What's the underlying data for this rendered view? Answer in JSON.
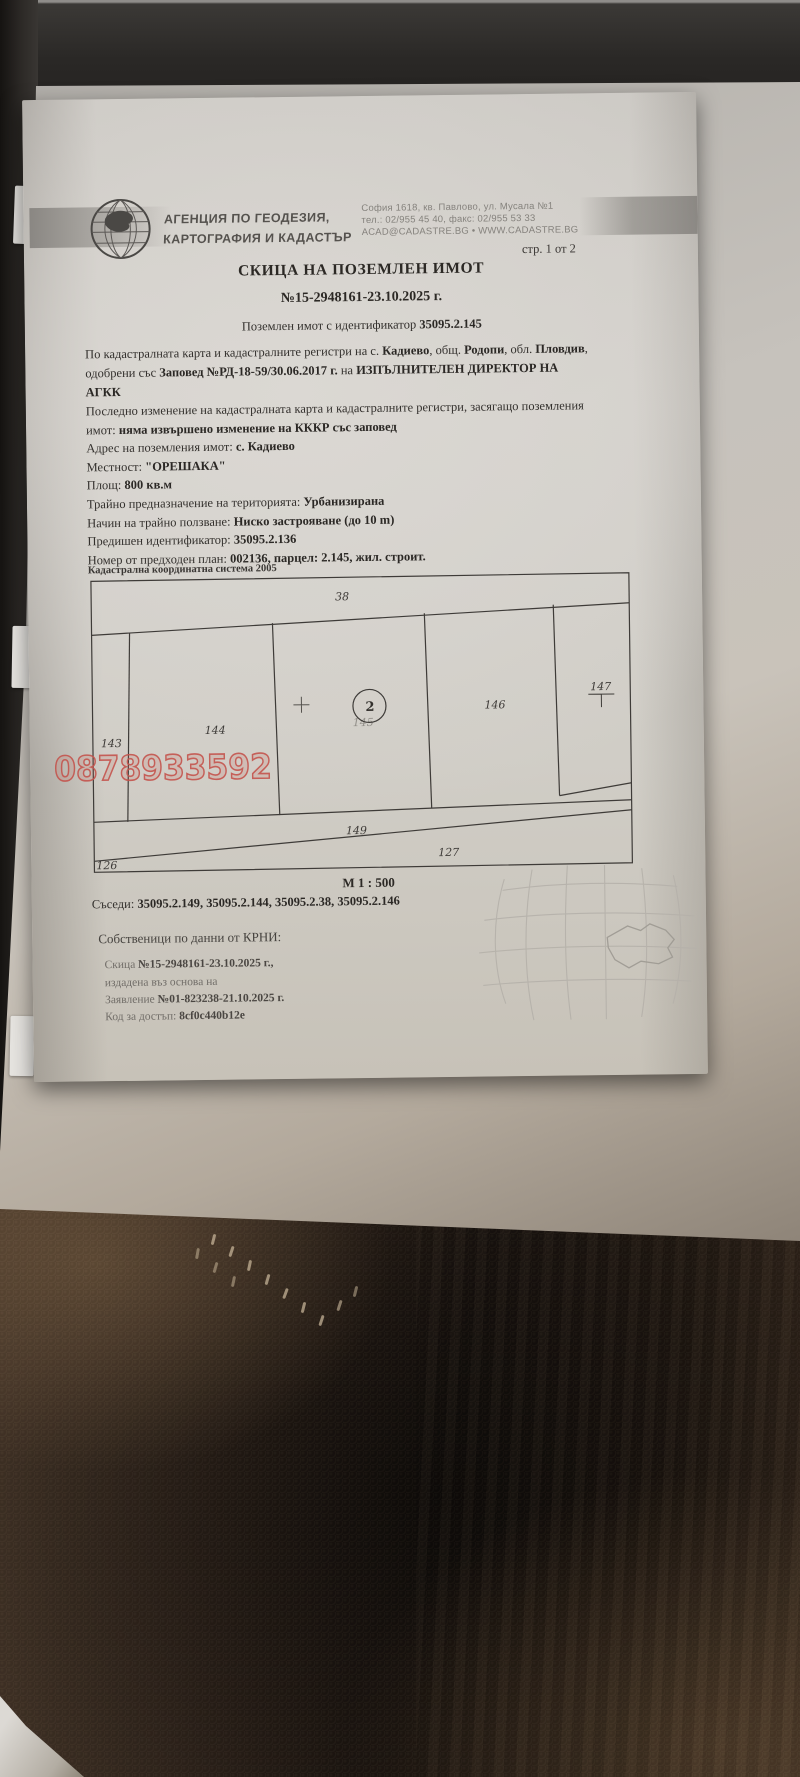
{
  "colors": {
    "watermark_red": "#c4544d",
    "paper": "#d0cdc8",
    "carpet_brown": "#2a211a",
    "ink": "#33302d"
  },
  "header": {
    "agency_line1": "АГЕНЦИЯ ПО ГЕОДЕЗИЯ,",
    "agency_line2": "КАРТОГРАФИЯ И КАДАСТЪР",
    "address_line1": "София 1618, кв. Павлово, ул. Мусала №1",
    "address_line2": "тел.: 02/955 45 40, факс: 02/955 53 33",
    "address_line3": "ACAD@CADASTRE.BG • WWW.CADASTRE.BG",
    "page_indicator": "стр. 1 от 2"
  },
  "title": "СКИЦА НА ПОЗЕМЛЕН ИМОТ",
  "document_number": "№15-2948161-23.10.2025 г.",
  "property_line": {
    "prefix": "Поземлен имот с идентификатор ",
    "id": "35095.2.145"
  },
  "para1": {
    "l1s1": "По кадастралната карта и кадастралните регистри на с. ",
    "l1s2": "Кадиево",
    "l1s3": ", общ. ",
    "l1s4": "Родопи",
    "l1s5": ", обл. ",
    "l1s6": "Пловдив",
    "l1s7": ",",
    "l2s1": "одобрени със ",
    "l2s2": "Заповед №РД-18-59/30.06.2017 г.",
    "l2s3": " на ",
    "l2s4": "ИЗПЪЛНИТЕЛЕН ДИРЕКТОР НА",
    "l3s1": "АГКК"
  },
  "para2": {
    "l1": "Последно изменение на кадастралната карта и кадастралните регистри, засягащо поземления",
    "l2s1": "имот: ",
    "l2s2": "няма извършено изменение на КККР със заповед"
  },
  "fields": [
    {
      "label": "Адрес на поземления имот: ",
      "value": "с. Кадиево"
    },
    {
      "label": "Местност: ",
      "value": "\"ОРЕШАКА\""
    },
    {
      "label": "Площ: ",
      "value": "800 кв.м"
    },
    {
      "label": "Трайно предназначение на територията: ",
      "value": "Урбанизирана"
    },
    {
      "label": "Начин на трайно ползване: ",
      "value": "Ниско застрояване (до 10 m)"
    },
    {
      "label": "Предишен идентификатор: ",
      "value": "35095.2.136"
    },
    {
      "label": "Номер от предходен план: ",
      "value": "002136, парцел: 2.145, жил. строит."
    }
  ],
  "map": {
    "coordinate_system": "Кадастрална координатна система 2005",
    "scale": "М 1 : 500",
    "parcels": {
      "p38": "38",
      "p143": "143",
      "p144": "144",
      "p145": "145",
      "p145_point": "2",
      "p146": "146",
      "p147": "147",
      "p149": "149",
      "p126": "126",
      "p127": "127"
    }
  },
  "neighbors": {
    "label": "Съседи: ",
    "value": "35095.2.149, 35095.2.144, 35095.2.38, 35095.2.146"
  },
  "owners": {
    "heading": "Собственици по данни от КРНИ:",
    "sketch_prefix": "Скица ",
    "sketch_number": "№15-2948161-23.10.2025 г.,",
    "based_on": "издадена въз основа на",
    "application_prefix": "Заявление ",
    "application_number": "№01-823238-21.10.2025 г.",
    "access_code_label": "Код за достъп: ",
    "access_code": "8cf0c440b12e"
  },
  "watermark_phone": "0878933592"
}
